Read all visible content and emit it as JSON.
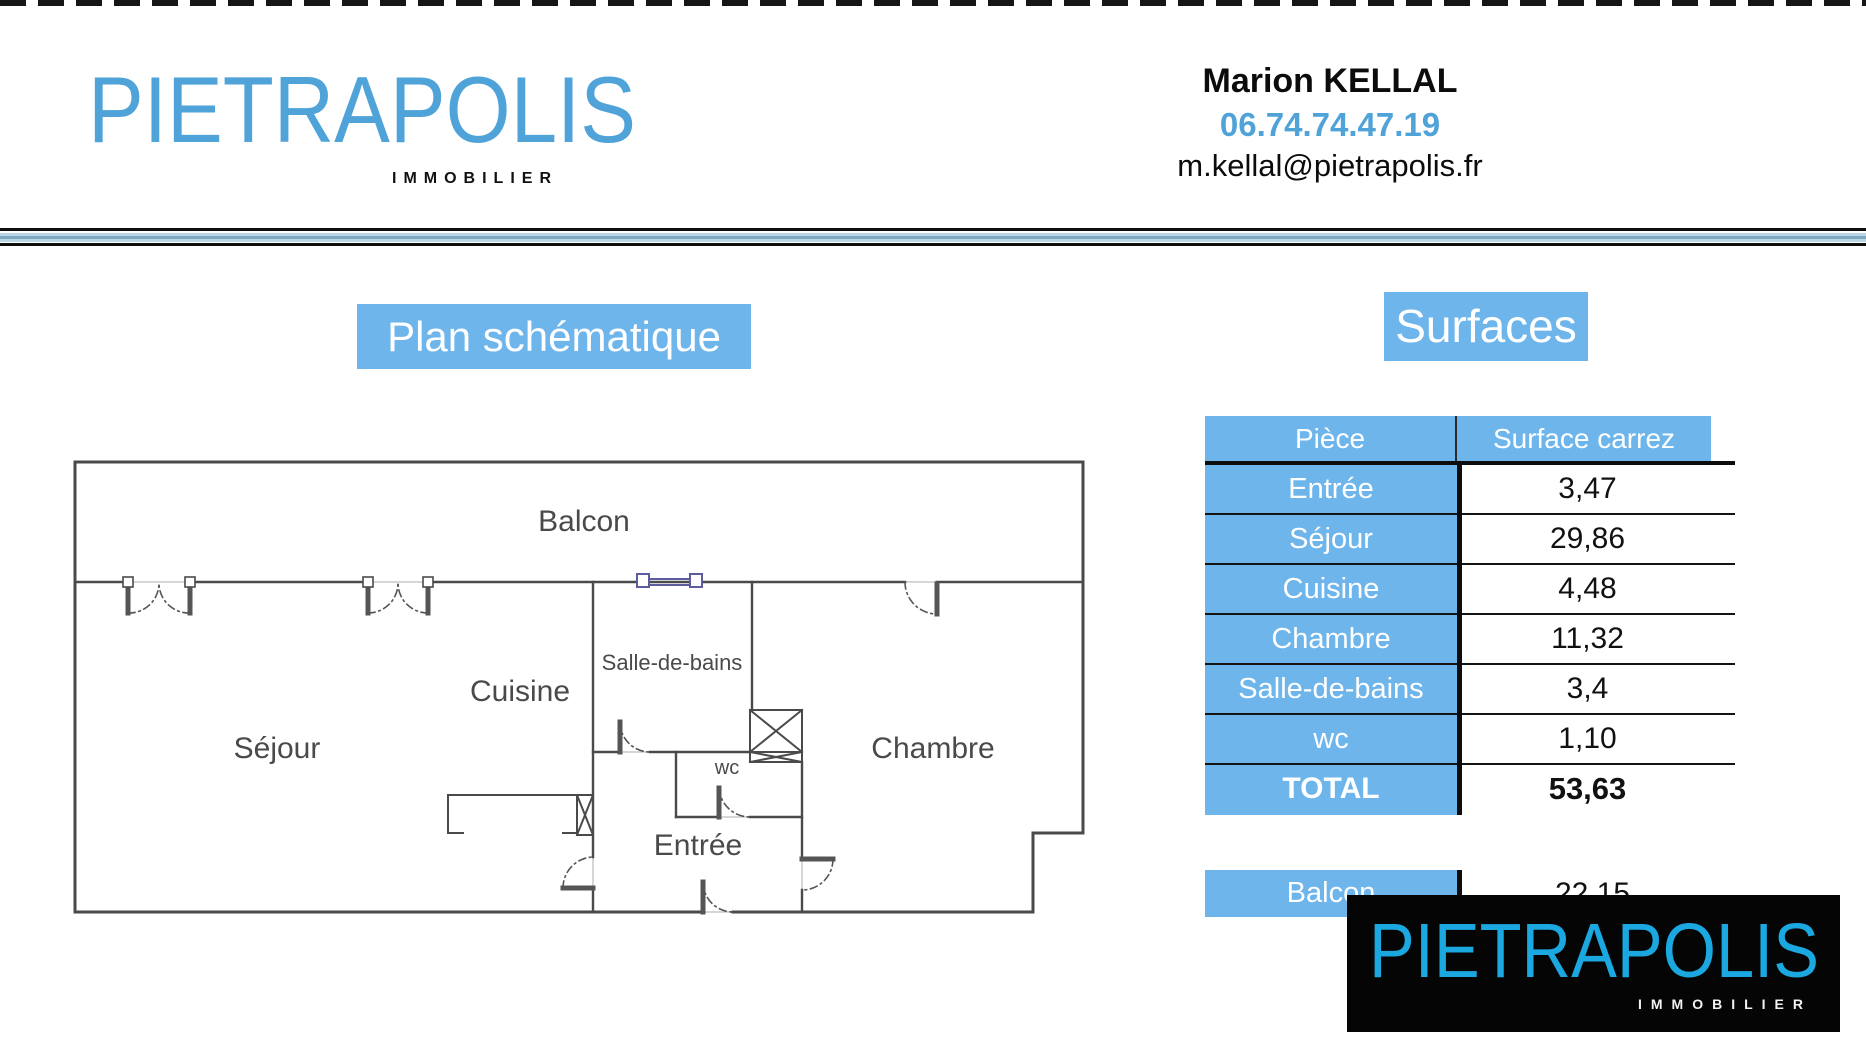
{
  "header": {
    "brand": "PIETRAPOLIS",
    "brand_sub": "IMMOBILIER",
    "agent_name": "Marion KELLAL",
    "agent_phone": "06.74.74.47.19",
    "agent_email": "m.kellal@pietrapolis.fr"
  },
  "plan": {
    "title": "Plan schématique",
    "labels": {
      "balcon": "Balcon",
      "sejour": "Séjour",
      "cuisine": "Cuisine",
      "salle_de_bains": "Salle-de-bains",
      "wc": "wc",
      "entree": "Entrée",
      "chambre": "Chambre"
    }
  },
  "surfaces": {
    "title": "Surfaces",
    "columns": [
      "Pièce",
      "Surface carrez"
    ],
    "rows": [
      {
        "label": "Entrée",
        "value": "3,47"
      },
      {
        "label": "Séjour",
        "value": "29,86"
      },
      {
        "label": "Cuisine",
        "value": "4,48"
      },
      {
        "label": "Chambre",
        "value": "11,32"
      },
      {
        "label": "Salle-de-bains",
        "value": "3,4"
      },
      {
        "label": "wc",
        "value": "1,10"
      }
    ],
    "total": {
      "label": "TOTAL",
      "value": "53,63"
    },
    "balcon": {
      "label": "Balcon",
      "value": "22,15"
    }
  },
  "footer_logo": {
    "brand": "PIETRAPOLIS",
    "brand_sub": "IMMOBILIER"
  },
  "colors": {
    "accent_blue": "#6eb5ec",
    "logo_blue": "#4fa3d8",
    "footer_logo_blue": "#1ba7e0",
    "window_symbol_blue": "#5c5c9e"
  }
}
